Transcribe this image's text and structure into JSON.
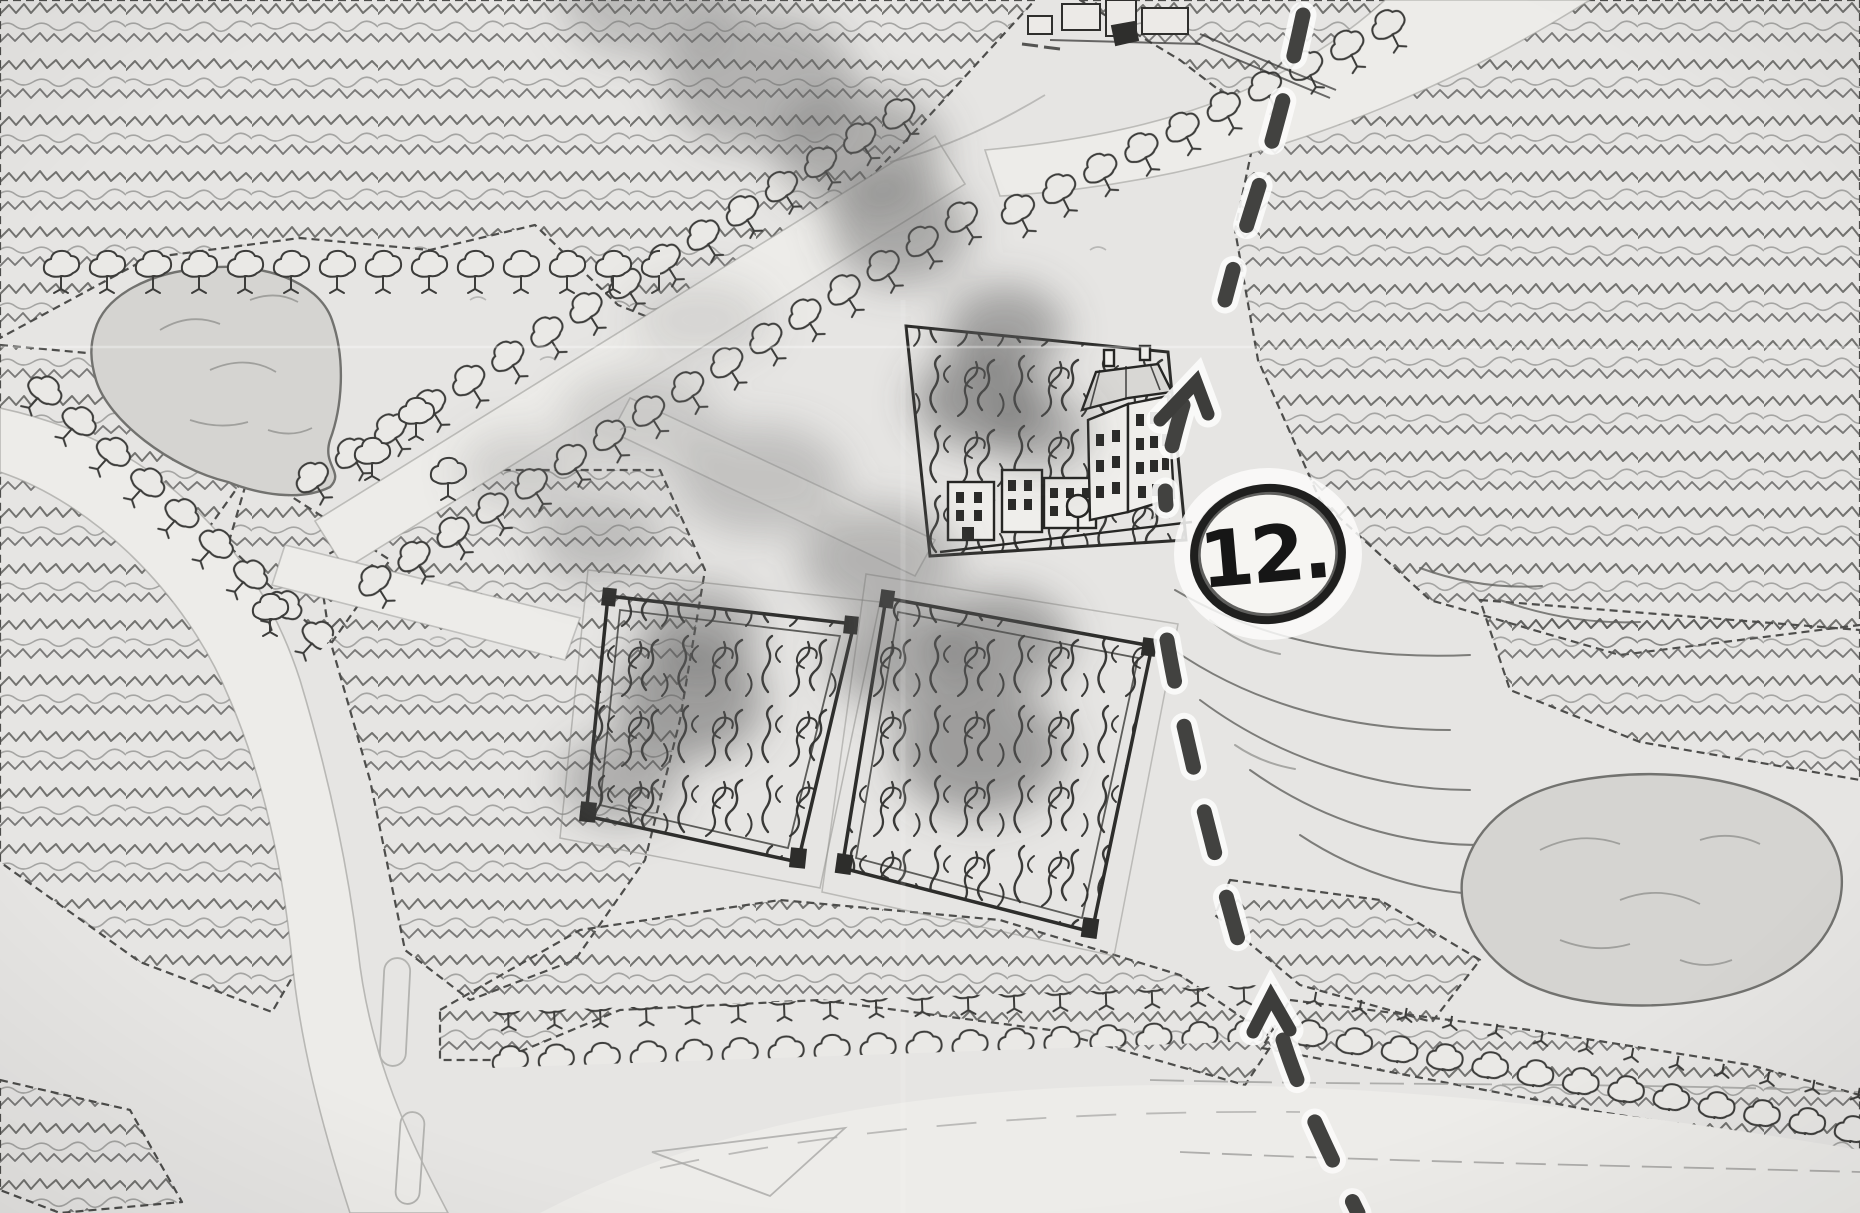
{
  "map": {
    "marker": {
      "label": "12."
    },
    "features": [
      "forest-scribble-canopy",
      "pond-upper-left",
      "pond-east",
      "curved-road-west",
      "tree-lined-avenue",
      "road-top-right",
      "road-bottom",
      "burning-compound-left",
      "burning-compound-right",
      "burning-manor-compound",
      "manor-buildings",
      "smoke-plumes",
      "rock-ledges",
      "dashed-route",
      "route-arrow-up-upper",
      "route-arrow-up-lower",
      "top-edge-buildings"
    ],
    "colors": {
      "paper": "#e6e5e3",
      "road_fill": "#edece9",
      "ink": "#3c3c3a",
      "water_fill": "#d5d4d1",
      "smoke": "#5f5f5f",
      "route_dash": "#424240",
      "route_halo": "#fbfbfa",
      "marker_fill": "#f6f5f2",
      "marker_ink": "#1f1f1e"
    }
  }
}
